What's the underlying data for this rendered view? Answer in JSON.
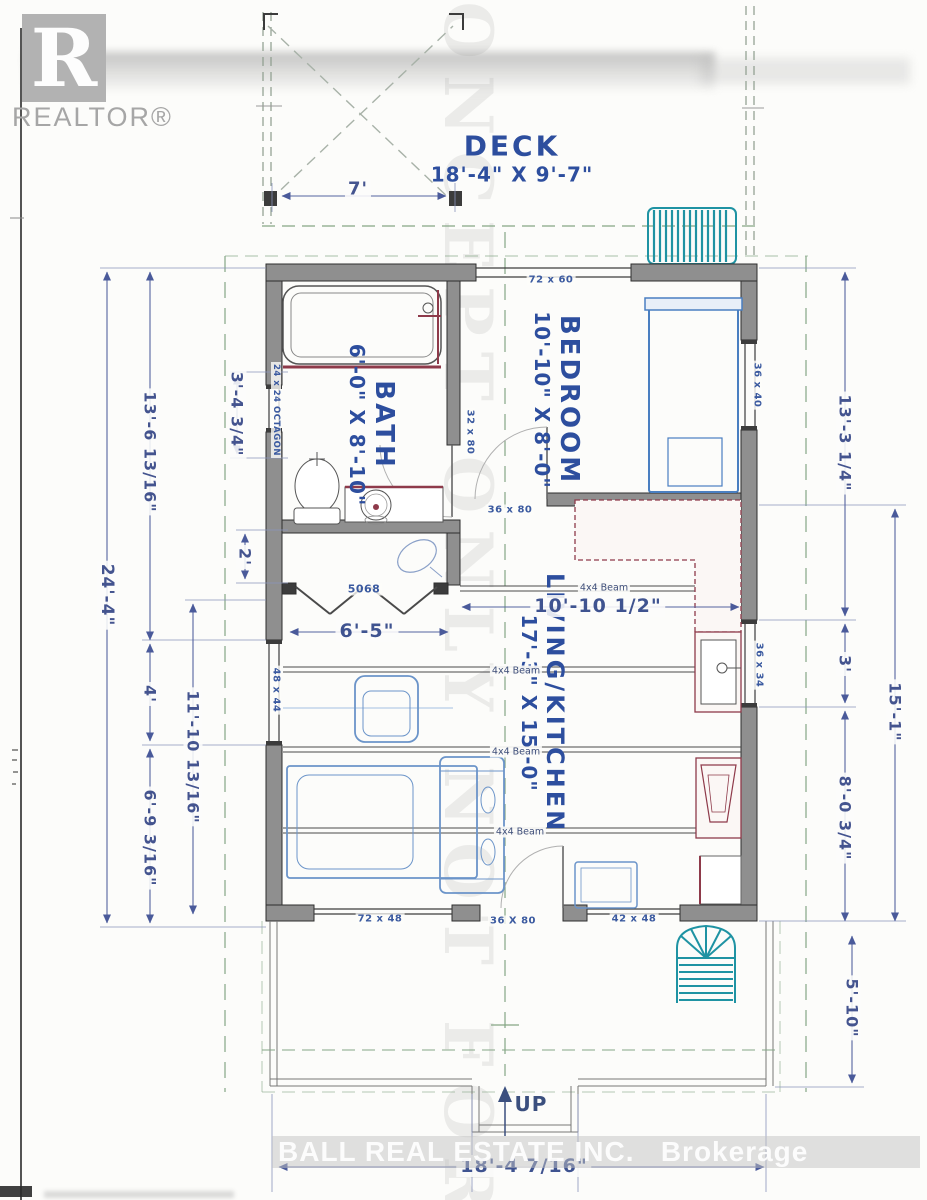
{
  "branding": {
    "logo_letter": "R",
    "logo_text": "REALTOR®",
    "brokerage": "BALL REAL ESTATE INC.   Brokerage",
    "concept_watermark": "CONCEPT ONLY NOT FOR"
  },
  "rooms": {
    "deck": {
      "name": "DECK",
      "dims": "18'-4\" X 9'-7\""
    },
    "bedroom": {
      "name": "BEDROOM",
      "dims": "10'-10\" X 8'-0\""
    },
    "bath": {
      "name": "BATH",
      "dims": "6'-0\" X 8'-10\""
    },
    "living": {
      "name": "LIVING/KITCHEN",
      "dims": "17'-3\" X 15'-0\""
    }
  },
  "dimensions": {
    "deck_width": "7'",
    "overall_height": "24'-4\"",
    "left_upper": "13'-6 13/16\"",
    "bath_window": "3'-4 3/4\"",
    "closet_depth": "2'",
    "left_mid": "4'",
    "living_left": "11'-10 13/16\"",
    "left_lower": "6'-9 3/16\"",
    "right_upper": "13'-3 1/4\"",
    "right_small": "3'",
    "right_tall": "15'-1\"",
    "right_lower": "8'-0 3/4\"",
    "porch_height": "5'-10\"",
    "living_width": "10'-10 1/2\"",
    "closet_width": "6'-5\"",
    "overall_width": "18'-4 7/16\""
  },
  "openings": {
    "slider": "72 x 60",
    "bedroom_window": "36 x 40",
    "octagon_window": "24 x 24 OCTAGON",
    "bath_door": "32 x 80",
    "bedroom_door": "36 x 80",
    "closet_door": "5068",
    "living_window_left": "48 x 44",
    "kitchen_window": "36 x 34",
    "front_window_left": "72 x 48",
    "entry_door": "36 X 80",
    "front_window_right": "42 x 48"
  },
  "structure": {
    "beam": "4x4 Beam",
    "stairs_direction": "UP"
  }
}
